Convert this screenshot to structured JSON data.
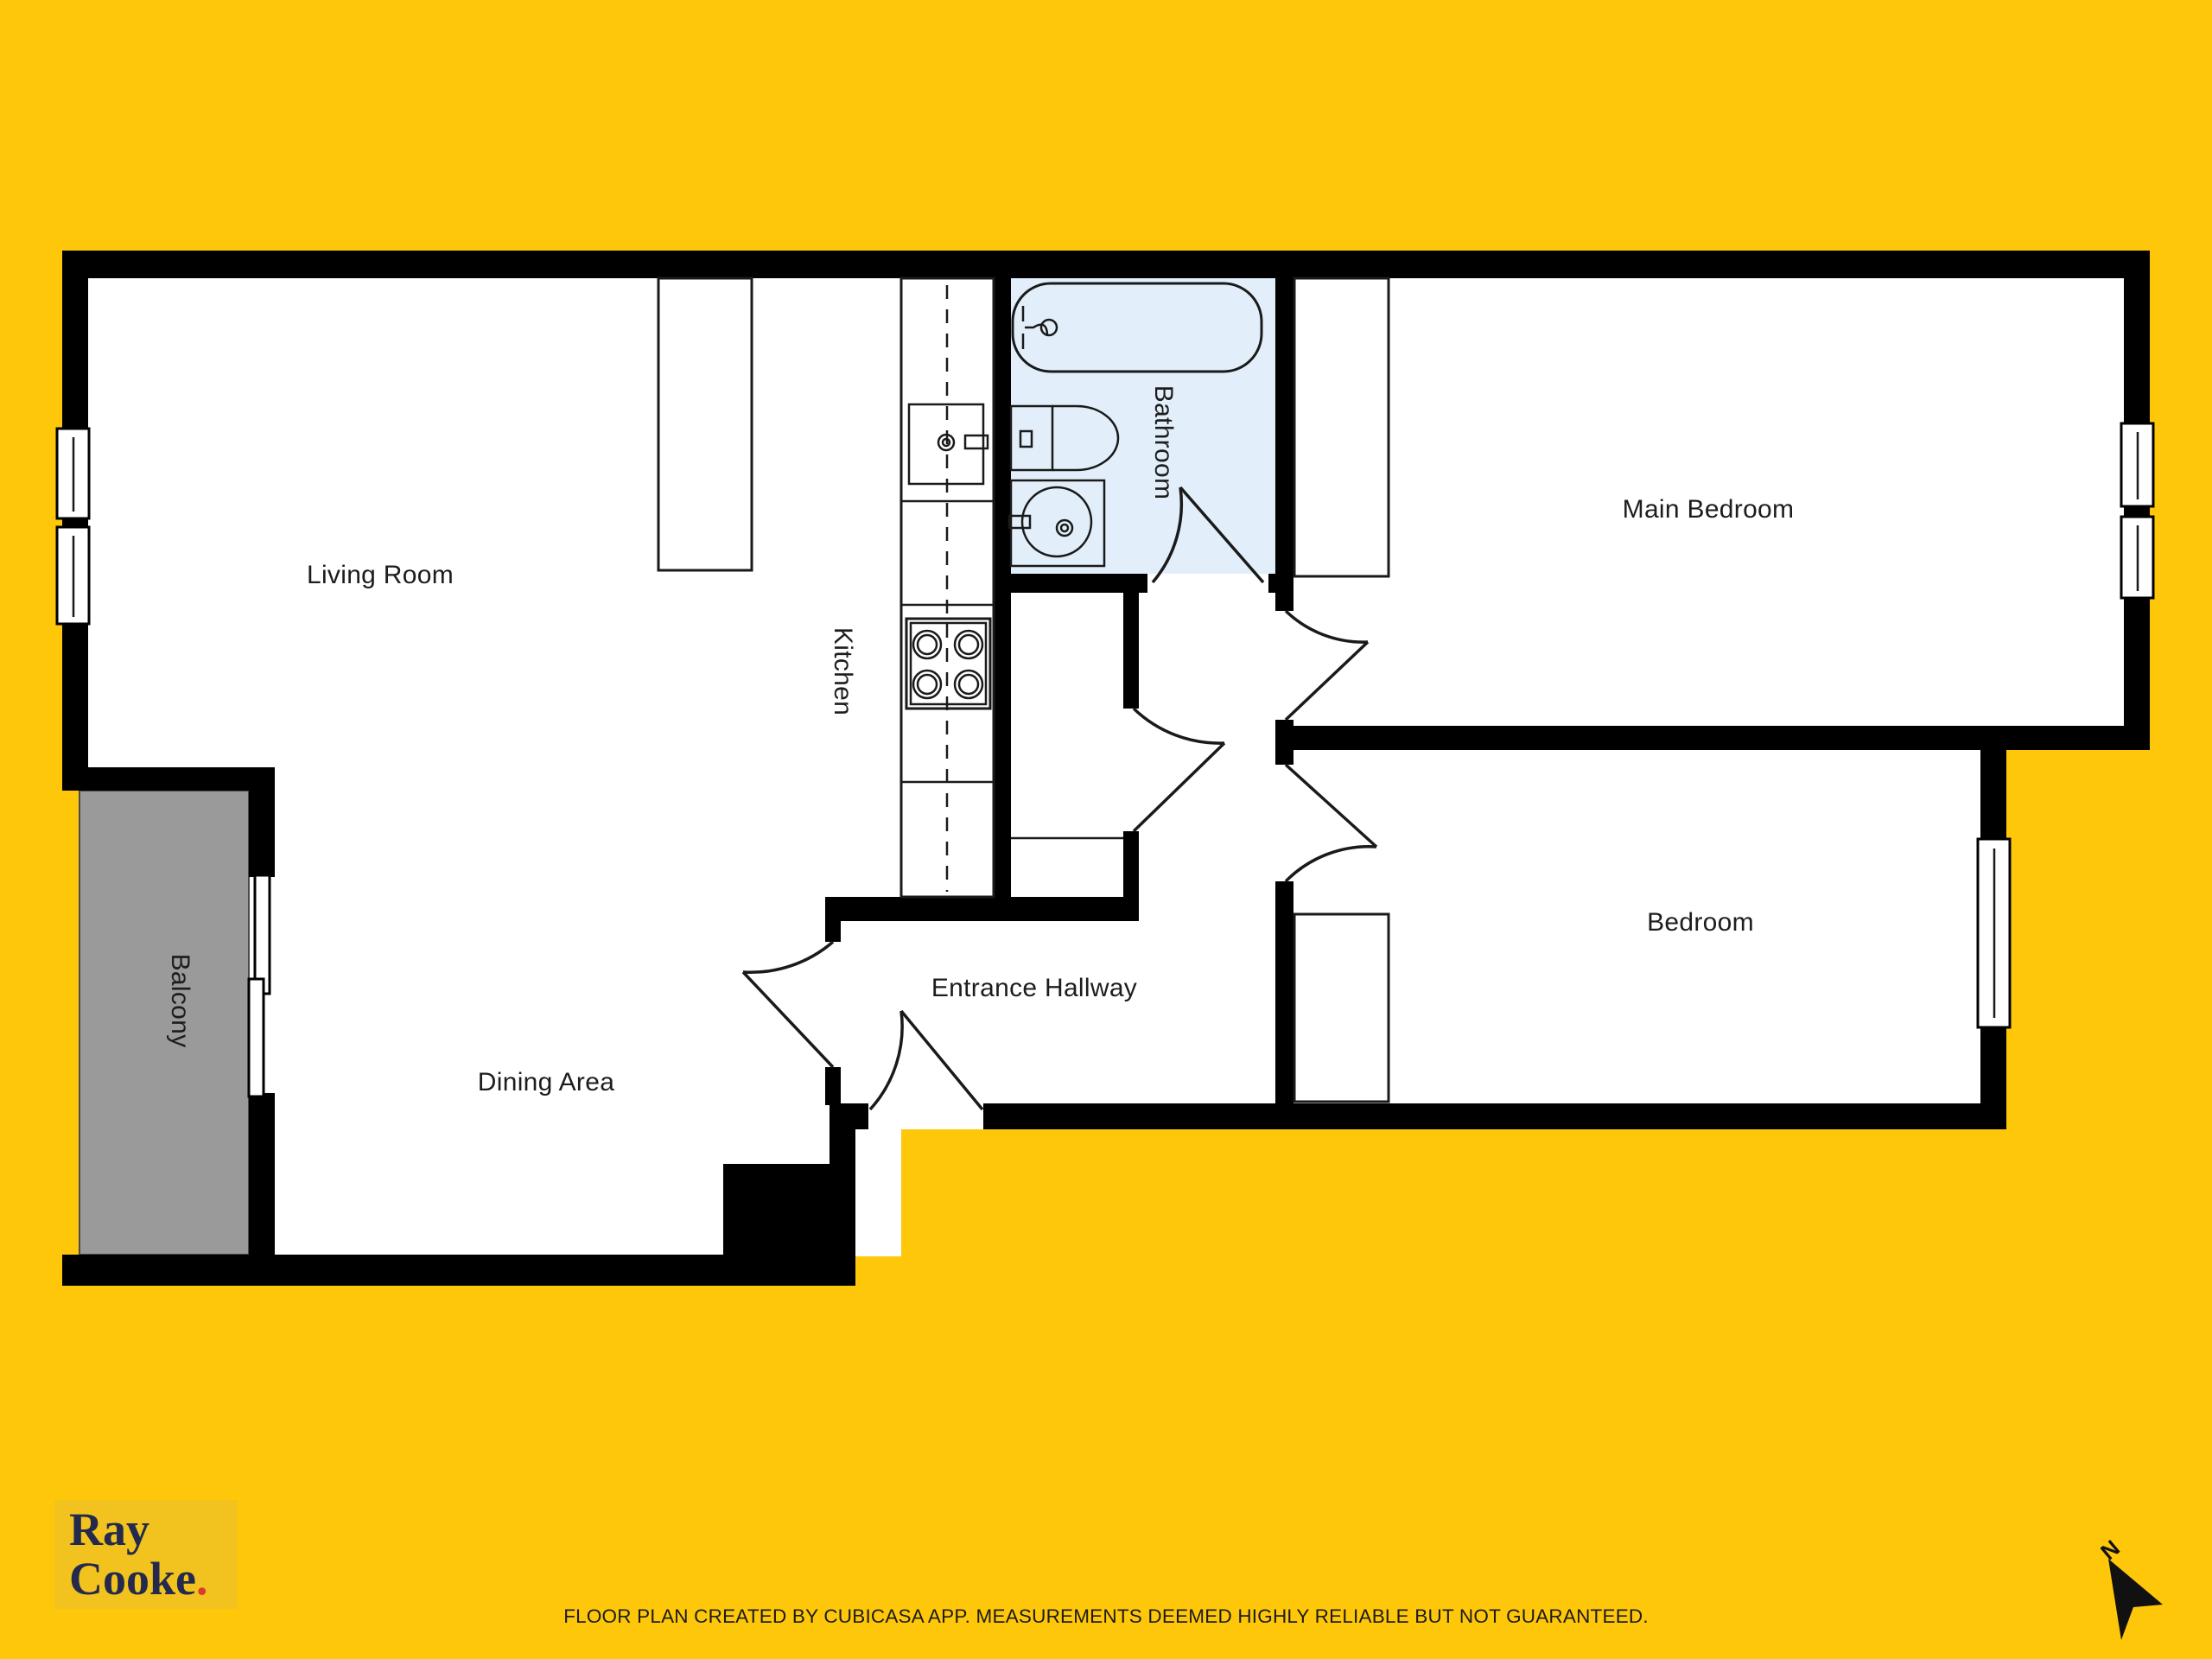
{
  "page": {
    "background": "#FFC709"
  },
  "floor_plan": {
    "labels": {
      "living_room": "Living Room",
      "dining_area": "Dining Area",
      "kitchen": "Kitchen",
      "bathroom": "Bathroom",
      "main_bedroom": "Main Bedroom",
      "bedroom": "Bedroom",
      "entrance_hallway": "Entrance Hallway",
      "balcony": "Balcony"
    },
    "colors": {
      "wall": "#000000",
      "room_fill": "#FFFFFF",
      "bathroom_fill": "#E2EFFA",
      "balcony_fill": "#9A9A9A",
      "line": "#1A1A1A"
    }
  },
  "branding": {
    "logo_line1": "Ray",
    "logo_line2": "Cooke",
    "logo_dot": ".",
    "colors": {
      "box": "#F2C31E",
      "text": "#232A4D",
      "dot": "#DC3A30"
    }
  },
  "compass": {
    "label": "N"
  },
  "footer": {
    "disclaimer": "FLOOR PLAN CREATED BY CUBICASA APP. MEASUREMENTS DEEMED HIGHLY RELIABLE BUT NOT GUARANTEED."
  }
}
